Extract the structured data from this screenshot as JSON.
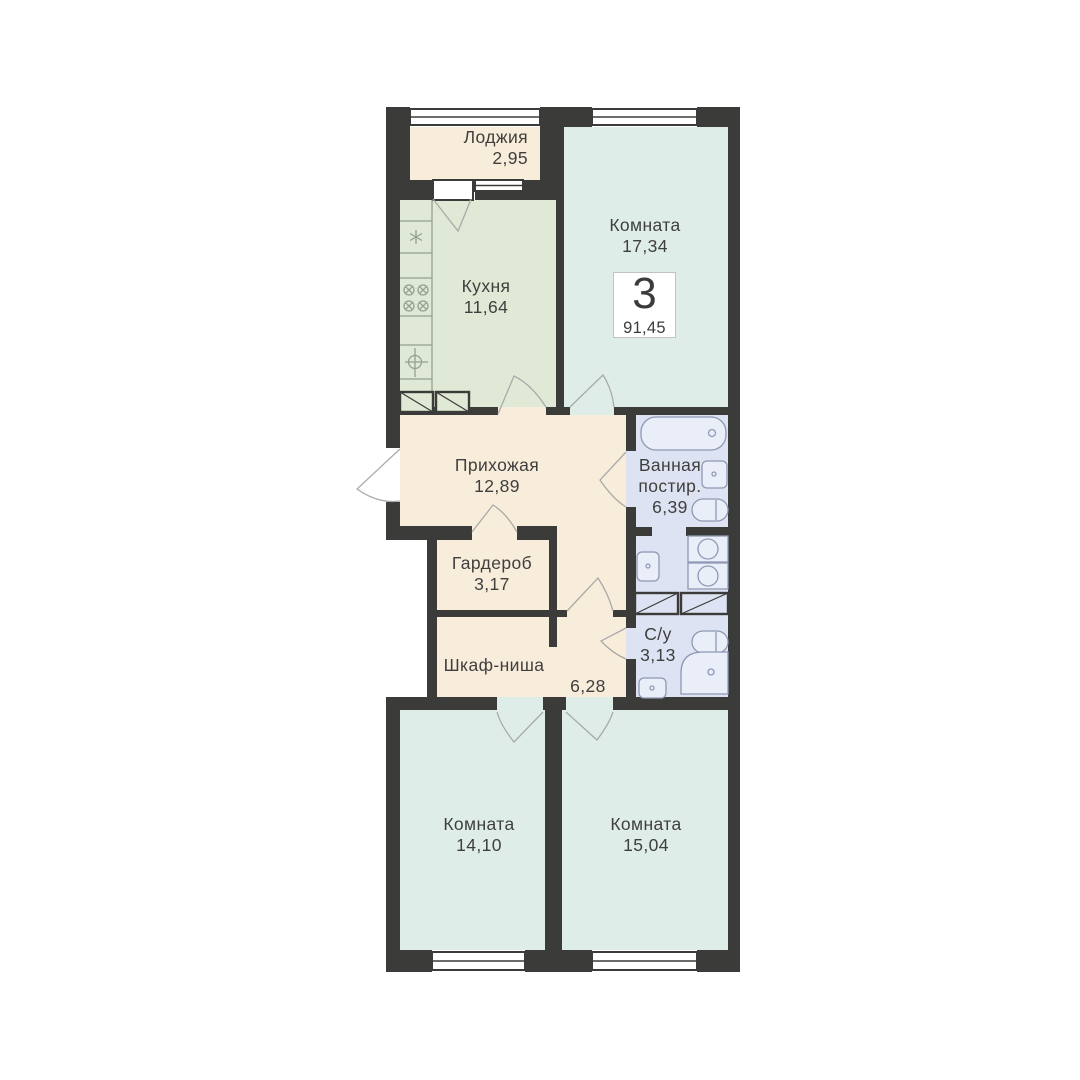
{
  "plan": {
    "badge": {
      "rooms_count": "3",
      "total_area": "91,45"
    },
    "rooms": [
      {
        "id": "loggia",
        "name": "Лоджия",
        "area": "2,95"
      },
      {
        "id": "kitchen",
        "name": "Кухня",
        "area": "11,64"
      },
      {
        "id": "living-room-1",
        "name": "Комната",
        "area": "17,34"
      },
      {
        "id": "hallway",
        "name": "Прихожая",
        "area": "12,89"
      },
      {
        "id": "bathroom-laundry",
        "name": "Ванная",
        "name_line2": "постир.",
        "area": "6,39"
      },
      {
        "id": "wardrobe",
        "name": "Гардероб",
        "area": "3,17"
      },
      {
        "id": "closet-niche",
        "name": "Шкаф-ниша",
        "area": "6,28"
      },
      {
        "id": "wc",
        "name": "С/у",
        "area": "3,13"
      },
      {
        "id": "living-room-2",
        "name": "Комната",
        "area": "14,10"
      },
      {
        "id": "living-room-3",
        "name": "Комната",
        "area": "15,04"
      }
    ],
    "colors": {
      "wall": "#3b3b39",
      "loggia_hallway_fill": "#f8ecdb",
      "kitchen_fill": "#dfe9d6",
      "room_fill": "#dfede8",
      "bathroom_fill": "#dee3f3",
      "background": "#ffffff",
      "door_arc": "#a8aba8",
      "fixture_stroke_kitchen": "#94a28d",
      "fixture_stroke_bathroom": "#8e99b4",
      "text": "#3f3f3d"
    }
  }
}
